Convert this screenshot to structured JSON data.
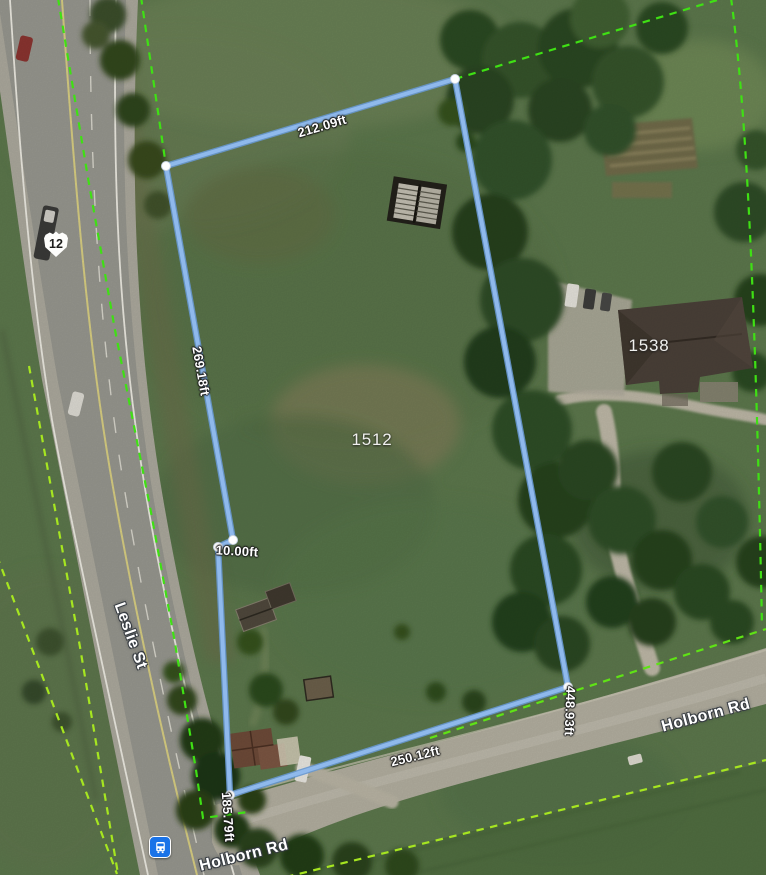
{
  "map": {
    "highway_shield": {
      "text": "12"
    },
    "parcels": {
      "p1512": "1512",
      "p1538": "1538"
    },
    "roads": {
      "leslie": "Leslie St",
      "holborn_west": "Holborn Rd",
      "holborn_east": "Holborn Rd"
    },
    "measurements": {
      "top": "212.09ft",
      "west": "269.18ft",
      "jog": "10.00ft",
      "southwest": "185.79ft",
      "south": "250.12ft",
      "east": "448.93ft"
    },
    "icons": {
      "transit": "bus-stop-icon",
      "shield": "highway-12-shield-icon"
    },
    "colors": {
      "measure_line": "#8fb9ec",
      "measure_line_edge": "#6797cf",
      "measure_vertex": "#ffffff",
      "parcel_line_green": "#3fe014",
      "parcel_line_yellow_green": "#a6e620",
      "transit_blue": "#1a73e8",
      "shield_text": "#1d1d1b",
      "label_text": "#ffffff"
    }
  }
}
